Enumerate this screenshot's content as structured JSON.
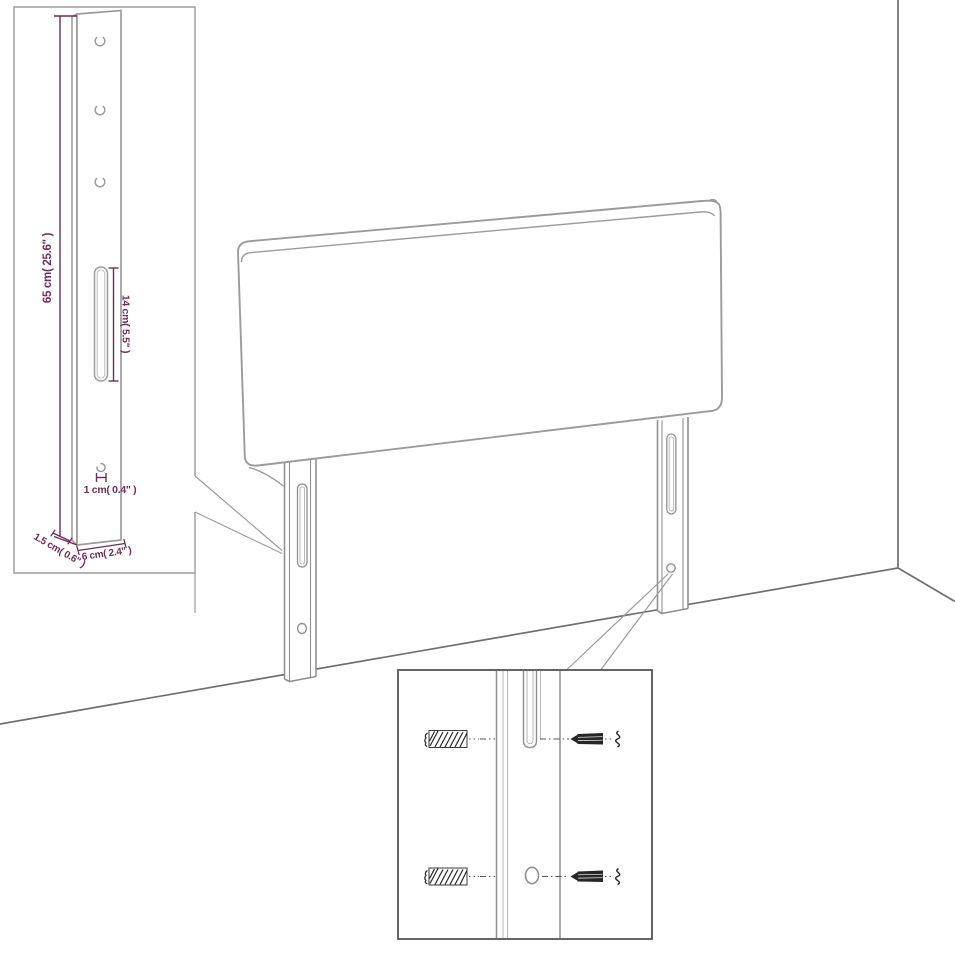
{
  "colors": {
    "background": "#ffffff",
    "dimension_accent": "#6e2c5a",
    "outline_light": "#9b9b9b",
    "outline_medium": "#6f6f6f",
    "detail_box_border": "#4a4a4a",
    "hardware_dark": "#262626"
  },
  "dimensions": {
    "post_height": "65 cm( 25.6\" )",
    "slot_length": "14 cm( 5.5\" )",
    "hole_size": "1 cm( 0.4\" )",
    "post_depth": "1.5 cm( 0.6\" )",
    "post_width": "6 cm( 2.4\" )"
  }
}
